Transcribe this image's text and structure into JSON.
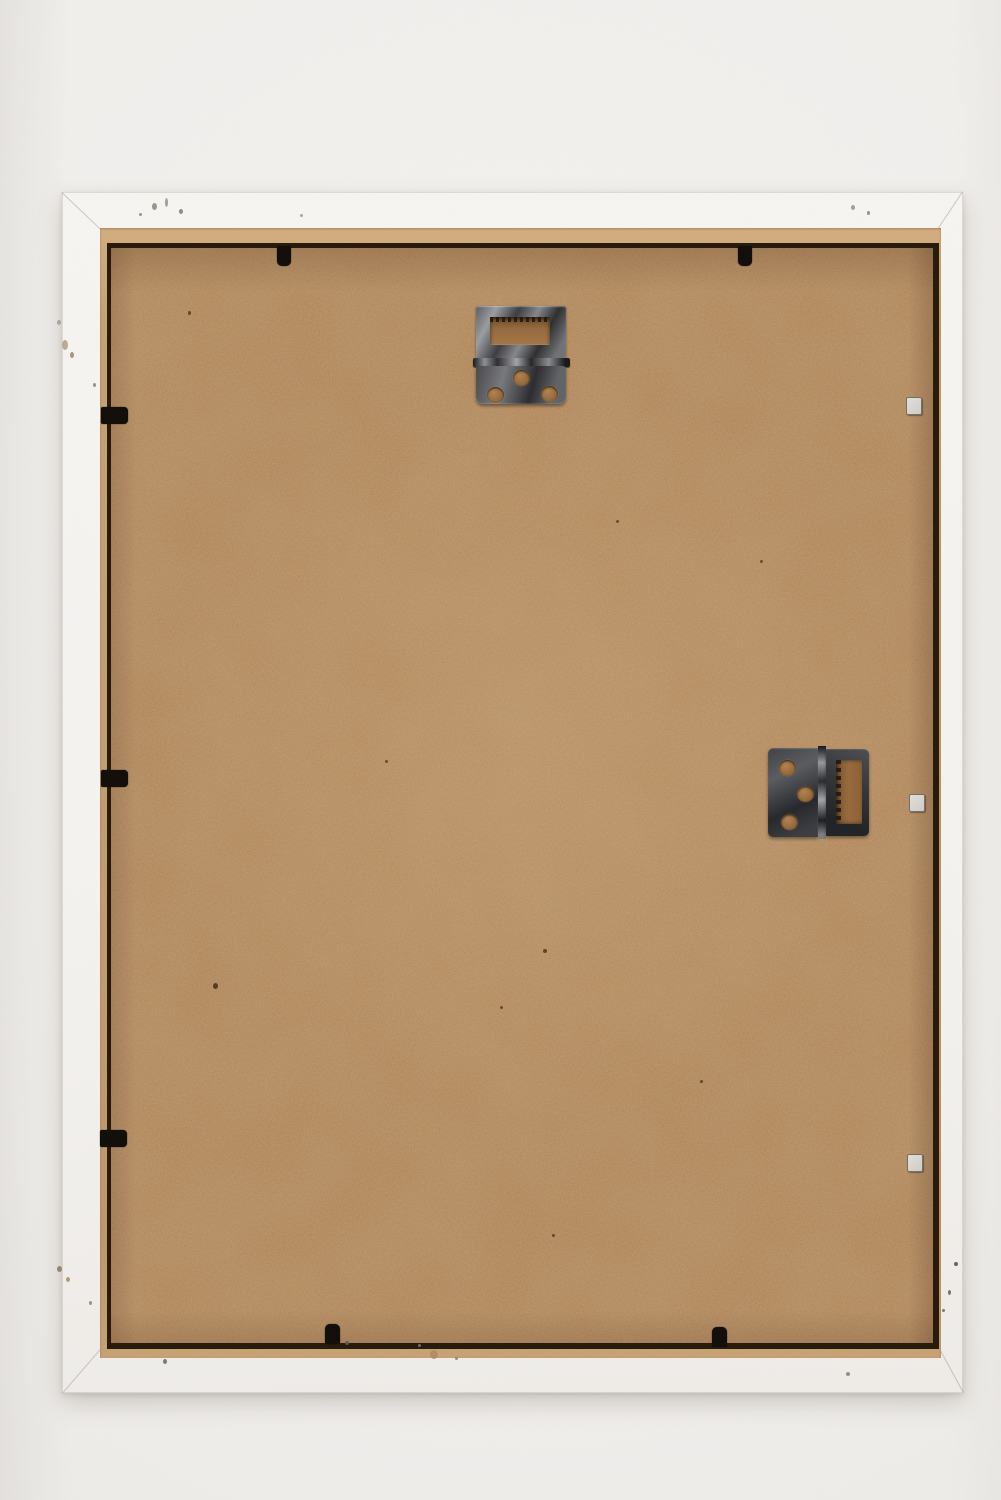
{
  "scene": {
    "title": "Back of a white wooden picture frame",
    "description": "Rear view photograph of a white wooden picture frame holding a brown hardboard (MDF) back panel. A metal hinge hanger with a slot is mounted near the top centre, a second hinge hanger with a serrated slot sits at the middle right. Small black retaining clips hold the panel along the top, left and bottom edges; three small light metal tabs sit along the right edge. The white frame shows small paint chips and dirt specks.",
    "objects": [
      "white-wooden-frame",
      "hardboard-back-panel",
      "top-hinge-hanger",
      "side-hinge-hanger",
      "retaining-clips",
      "metal-tabs",
      "paint-chips"
    ]
  },
  "colors": {
    "backdrop": "#f0eeeb",
    "frame_white": "#f6f4f1",
    "lip_tan": "#c9a274",
    "board_brown": "#ac7c4e",
    "gap_shadow": "#241708",
    "clip_black": "#0e0b07",
    "metal_dark": "#36363a",
    "metal_light": "#8d8f93",
    "tab_light": "#d8d6d2"
  },
  "hardware": {
    "top_hanger": {
      "name": "hinge-hanger-with-slot",
      "x": 473,
      "y": 303,
      "holes": 3
    },
    "side_hanger": {
      "name": "hinge-hanger-with-serrated-slot",
      "x": 768,
      "y": 746,
      "holes": 3
    }
  },
  "clips": {
    "top": [
      {
        "x": 277,
        "y": 246
      },
      {
        "x": 738,
        "y": 246
      }
    ],
    "left": [
      {
        "x": 101,
        "y": 407
      },
      {
        "x": 101,
        "y": 770
      },
      {
        "x": 100,
        "y": 1130
      }
    ],
    "bottom": [
      {
        "x": 325,
        "y": 1324
      },
      {
        "x": 712,
        "y": 1327
      }
    ],
    "right_tabs": [
      {
        "x": 906,
        "y": 397
      },
      {
        "x": 909,
        "y": 794
      },
      {
        "x": 907,
        "y": 1154
      }
    ]
  },
  "specks": [
    {
      "x": 152,
      "y": 203,
      "w": 5,
      "h": 7,
      "c": "#8f8a7d"
    },
    {
      "x": 165,
      "y": 198,
      "w": 3,
      "h": 9,
      "c": "#9a9589"
    },
    {
      "x": 179,
      "y": 209,
      "w": 4,
      "h": 5,
      "c": "#847f72"
    },
    {
      "x": 139,
      "y": 213,
      "w": 3,
      "h": 3,
      "c": "#8f8a7d"
    },
    {
      "x": 300,
      "y": 214,
      "w": 3,
      "h": 3,
      "c": "#a39e92"
    },
    {
      "x": 851,
      "y": 205,
      "w": 4,
      "h": 5,
      "c": "#99948a"
    },
    {
      "x": 867,
      "y": 211,
      "w": 3,
      "h": 4,
      "c": "#8a8578"
    },
    {
      "x": 62,
      "y": 340,
      "w": 6,
      "h": 10,
      "c": "#b3a284"
    },
    {
      "x": 70,
      "y": 352,
      "w": 4,
      "h": 6,
      "c": "#9c8c70"
    },
    {
      "x": 93,
      "y": 383,
      "w": 3,
      "h": 4,
      "c": "#8d887c"
    },
    {
      "x": 57,
      "y": 320,
      "w": 4,
      "h": 5,
      "c": "#a59d8c"
    },
    {
      "x": 57,
      "y": 1266,
      "w": 5,
      "h": 6,
      "c": "#8d7c5e"
    },
    {
      "x": 66,
      "y": 1277,
      "w": 4,
      "h": 5,
      "c": "#a8916c"
    },
    {
      "x": 89,
      "y": 1301,
      "w": 3,
      "h": 4,
      "c": "#8d887c"
    },
    {
      "x": 163,
      "y": 1359,
      "w": 4,
      "h": 5,
      "c": "#6f6a60"
    },
    {
      "x": 345,
      "y": 1341,
      "w": 4,
      "h": 4,
      "c": "#5f5a52"
    },
    {
      "x": 430,
      "y": 1350,
      "w": 8,
      "h": 9,
      "c": "#b28a60"
    },
    {
      "x": 418,
      "y": 1344,
      "w": 3,
      "h": 3,
      "c": "#7a7468"
    },
    {
      "x": 455,
      "y": 1357,
      "w": 3,
      "h": 3,
      "c": "#8a8476"
    },
    {
      "x": 954,
      "y": 1262,
      "w": 4,
      "h": 4,
      "c": "#55524c"
    },
    {
      "x": 948,
      "y": 1290,
      "w": 3,
      "h": 5,
      "c": "#66625a"
    },
    {
      "x": 942,
      "y": 1309,
      "w": 3,
      "h": 3,
      "c": "#716a5f"
    },
    {
      "x": 846,
      "y": 1372,
      "w": 4,
      "h": 4,
      "c": "#8a8478"
    },
    {
      "x": 213,
      "y": 983,
      "w": 5,
      "h": 6,
      "c": "#4a2f17"
    },
    {
      "x": 543,
      "y": 949,
      "w": 4,
      "h": 4,
      "c": "#54371c"
    },
    {
      "x": 500,
      "y": 1006,
      "w": 3,
      "h": 3,
      "c": "#5d4024"
    },
    {
      "x": 188,
      "y": 311,
      "w": 3,
      "h": 4,
      "c": "#5a3c1f"
    },
    {
      "x": 616,
      "y": 520,
      "w": 3,
      "h": 3,
      "c": "#5f4223"
    },
    {
      "x": 700,
      "y": 1080,
      "w": 3,
      "h": 3,
      "c": "#5a3d20"
    },
    {
      "x": 385,
      "y": 760,
      "w": 3,
      "h": 3,
      "c": "#5e4124"
    },
    {
      "x": 552,
      "y": 1234,
      "w": 3,
      "h": 3,
      "c": "#5a3d20"
    },
    {
      "x": 760,
      "y": 560,
      "w": 3,
      "h": 3,
      "c": "#60422a"
    }
  ]
}
